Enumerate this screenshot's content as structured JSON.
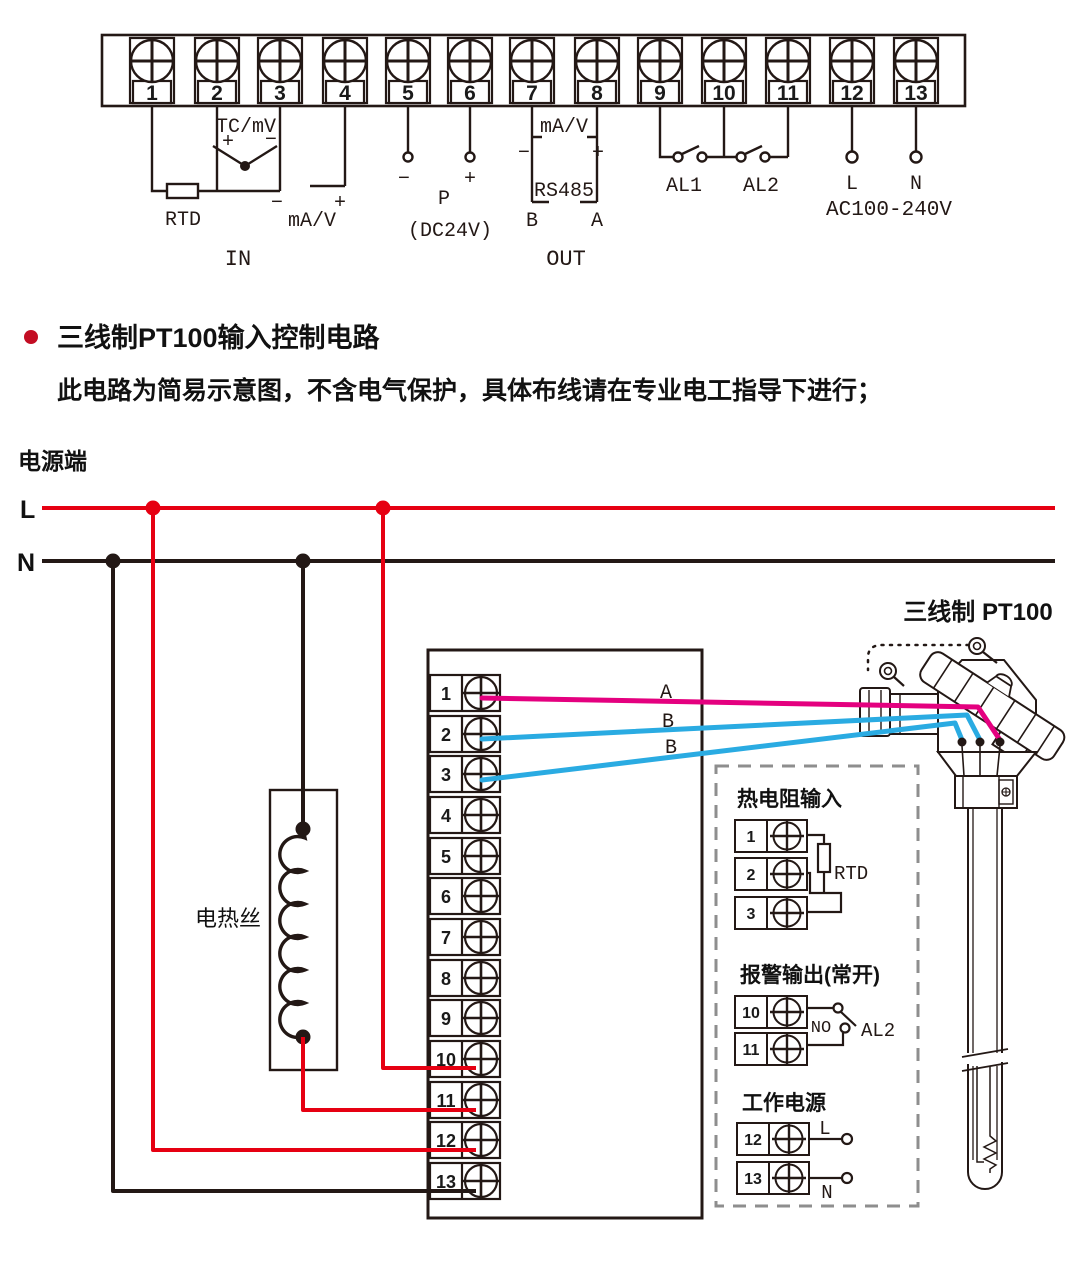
{
  "colors": {
    "accent_red": "#e60012",
    "wire_pink": "#e4007f",
    "wire_blue": "#2aabe2",
    "line_ink": "#231815",
    "dash_gray": "#8e8e8e",
    "bullet_red": "#c30d23"
  },
  "top_block": {
    "terminals": [
      "1",
      "2",
      "3",
      "4",
      "5",
      "6",
      "7",
      "8",
      "9",
      "10",
      "11",
      "12",
      "13"
    ],
    "tc_label": "TC/mV",
    "tc_plus": "+",
    "tc_minus": "−",
    "rtd_label": "RTD",
    "in_minus": "−",
    "in_ma_v": "mA/V",
    "in_plus": "+",
    "in_label": "IN",
    "p_minus": "−",
    "p_plus": "+",
    "p_label": "P",
    "p_sub": "(DC24V)",
    "out_ma_v": "mA/V",
    "out_minus": "−",
    "out_plus": "+",
    "rs485_label": "RS485",
    "rs485_b": "B",
    "rs485_a": "A",
    "out_label": "OUT",
    "al1_label": "AL1",
    "al2_label": "AL2",
    "l_label": "L",
    "n_label": "N",
    "ac_label": "AC100-240V"
  },
  "section": {
    "title": "三线制PT100输入控制电路",
    "note": "此电路为简易示意图，不含电气保护，具体布线请在专业电工指导下进行；"
  },
  "circuit": {
    "power_terminal_label": "电源端",
    "l_label": "L",
    "n_label": "N",
    "heater_label": "电热丝",
    "sensor_label": "三线制 PT100",
    "wire_a": "A",
    "wire_b1": "B",
    "wire_b2": "B",
    "terminals": [
      "1",
      "2",
      "3",
      "4",
      "5",
      "6",
      "7",
      "8",
      "9",
      "10",
      "11",
      "12",
      "13"
    ]
  },
  "detail_box": {
    "rtd_title": "热电阻输入",
    "rtd_terminals": [
      "1",
      "2",
      "3"
    ],
    "rtd_label": "RTD",
    "alarm_title": "报警输出(常开)",
    "alarm_terminals": [
      "10",
      "11"
    ],
    "no_label": "NO",
    "al2_label": "AL2",
    "power_title": "工作电源",
    "power_terminals": [
      "12",
      "13"
    ],
    "l_label": "L",
    "n_label": "N"
  }
}
